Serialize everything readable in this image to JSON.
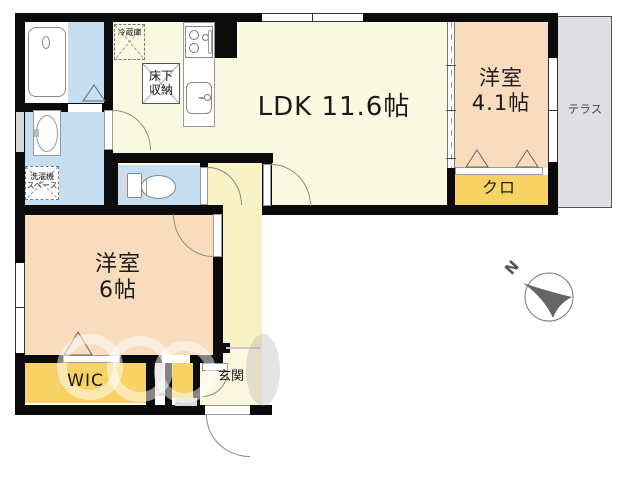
{
  "floor_plan": {
    "rooms": {
      "ldk": {
        "label": "LDK 11.6帖"
      },
      "western_room_41": {
        "name": "洋室",
        "size": "4.1帖"
      },
      "western_room_6": {
        "name": "洋室",
        "size": "6帖"
      },
      "closet": {
        "label": "クロ"
      },
      "walk_in_closet": {
        "label": "WIC"
      },
      "entrance": {
        "label": "玄関"
      },
      "terrace": {
        "label": "テラス"
      }
    },
    "fixtures": {
      "refrigerator": {
        "label": "冷蔵庫"
      },
      "underfloor_storage": {
        "line1": "床下",
        "line2": "収納"
      },
      "washer_space": {
        "line1": "洗濯機",
        "line2": "スペース"
      }
    },
    "compass": {
      "north_label": "N"
    },
    "colors": {
      "wall": "#0b0b0b",
      "ldk_fill": "#fafae2",
      "room_fill": "#f9dcbd",
      "closet_fill": "#f7d264",
      "wet_area_fill": "#c5def2",
      "hallway_fill": "#f9f2c6",
      "entrance_fill": "#fbf7e0",
      "terrace_fill": "#dfdfe3"
    }
  }
}
